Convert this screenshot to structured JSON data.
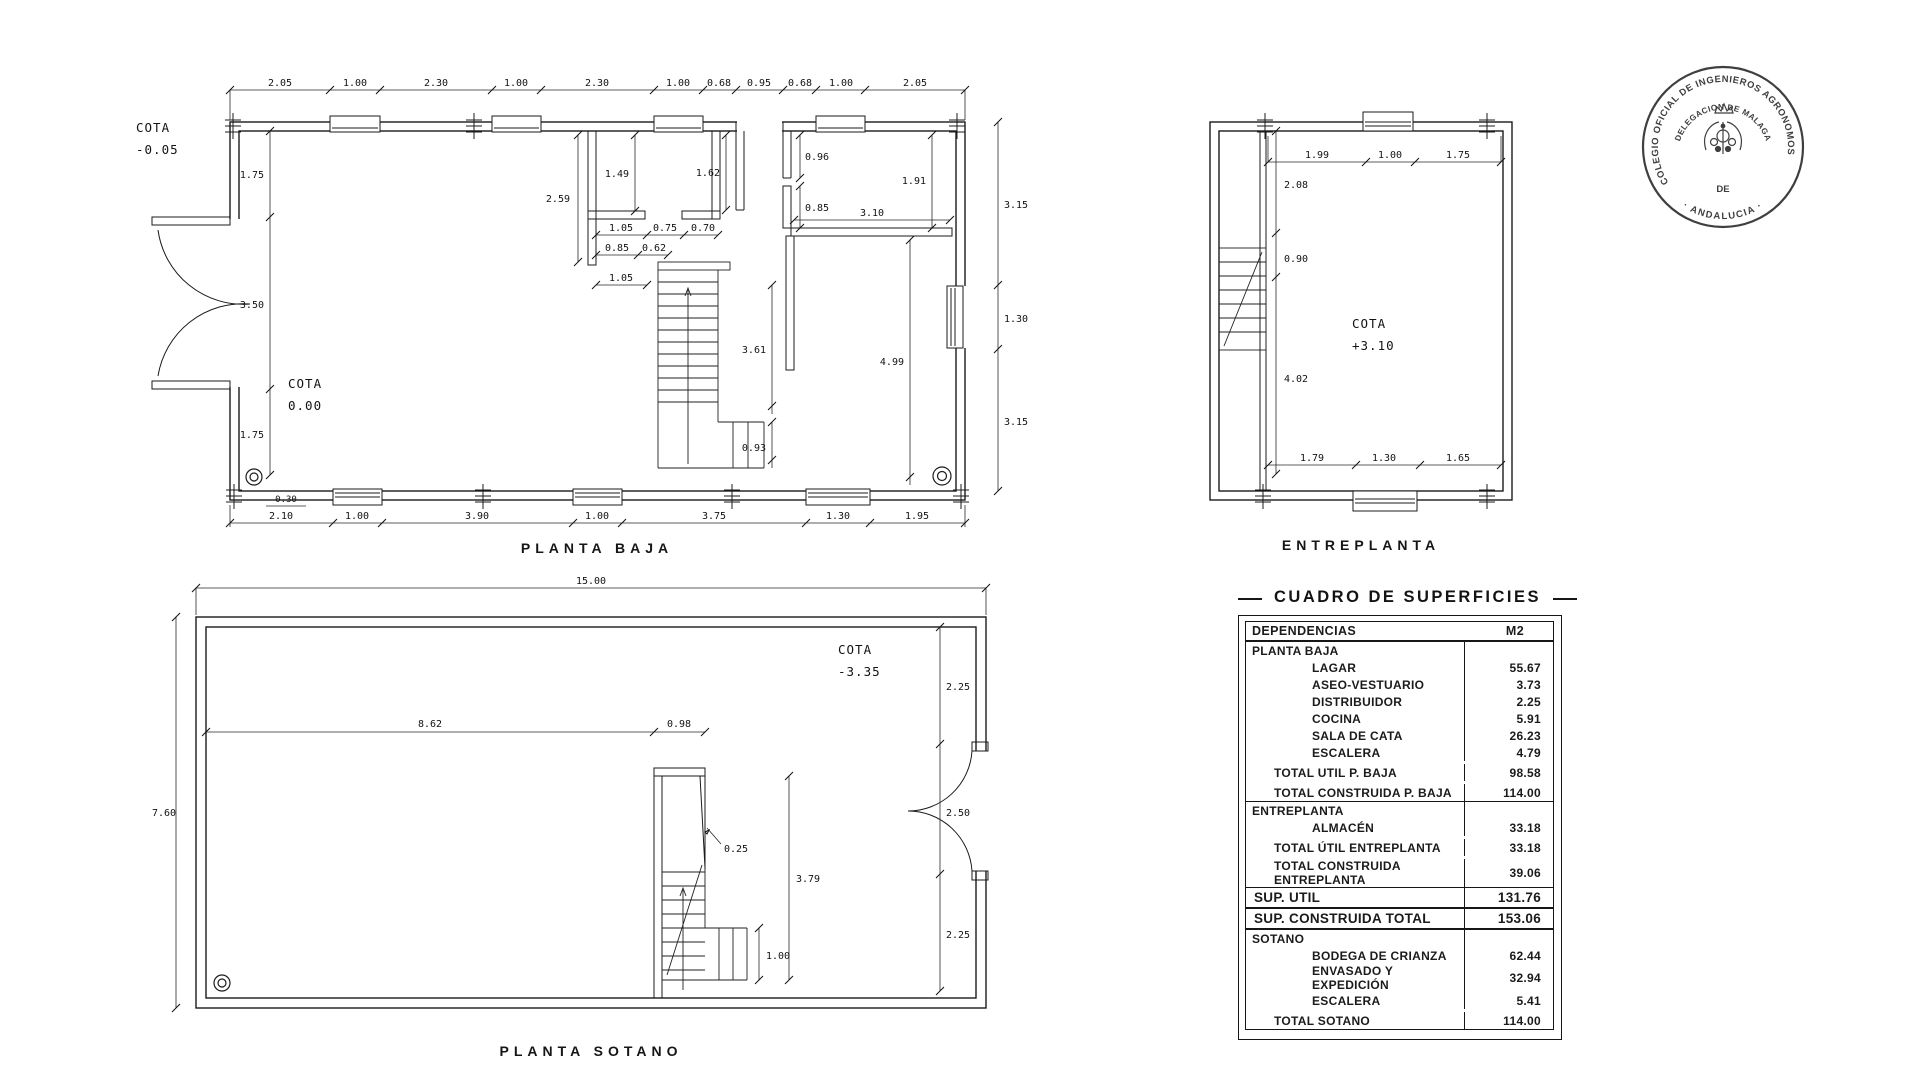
{
  "meta": {
    "ink": "#1b1b1b",
    "stamp_color": "#3f3f3f",
    "background": "#ffffff"
  },
  "plans": {
    "baja": {
      "label": "PLANTA BAJA",
      "cota_out": {
        "l1": "COTA",
        "l2": "-0.05"
      },
      "cota_in": {
        "l1": "COTA",
        "l2": "0.00"
      },
      "dims_top": [
        "2.05",
        "1.00",
        "2.30",
        "1.00",
        "2.30",
        "1.00",
        "0.68",
        "0.95",
        "0.68",
        "1.00",
        "2.05"
      ],
      "dims_bottom": [
        "2.10",
        "1.00",
        "3.90",
        "1.00",
        "3.75",
        "1.30",
        "1.95"
      ],
      "dims_left": [
        "1.75",
        "3.50",
        "1.75"
      ],
      "dims_right": [
        "3.15",
        "1.30",
        "3.15"
      ],
      "din": {
        "d259": "2.59",
        "d149": "1.49",
        "d105a": "1.05",
        "d075": "0.75",
        "d070": "0.70",
        "d085a": "0.85",
        "d062": "0.62",
        "d105b": "1.05",
        "d162": "1.62",
        "d096": "0.96",
        "d085b": "0.85",
        "d310": "3.10",
        "d191": "1.91",
        "d499": "4.99",
        "d361": "3.61",
        "d093": "0.93",
        "d030": "0.30"
      }
    },
    "entreplanta": {
      "label": "ENTREPLANTA",
      "cota": {
        "l1": "COTA",
        "l2": "+3.10"
      },
      "dims_top": [
        "1.99",
        "1.00",
        "1.75"
      ],
      "dims_left": [
        "2.08",
        "0.90",
        "4.02"
      ],
      "dims_bottom": [
        "1.79",
        "1.30",
        "1.65"
      ]
    },
    "sotano": {
      "label": "PLANTA SOTANO",
      "cota": {
        "l1": "COTA",
        "l2": "-3.35"
      },
      "dim_top": "15.00",
      "dim_left": "7.60",
      "dims_right": [
        "2.25",
        "2.50",
        "2.25"
      ],
      "din": {
        "d862": "8.62",
        "d098": "0.98",
        "d025": "0.25",
        "d379": "3.79",
        "d100": "1.00"
      }
    }
  },
  "stamp": {
    "ring_top": "COLEGIO OFICIAL DE INGENIEROS AGRONOMOS",
    "ring_bottom": "· ANDALUCIA ·",
    "inner_arc": "DELEGACION DE MALAGA",
    "center_word": "DE"
  },
  "table": {
    "title": "CUADRO DE SUPERFICIES",
    "col_label": "DEPENDENCIAS",
    "col_value": "M2",
    "rows": [
      {
        "label": "PLANTA BAJA",
        "value": "",
        "type": "section"
      },
      {
        "label": "LAGAR",
        "value": "55.67",
        "type": "item"
      },
      {
        "label": "ASEO-VESTUARIO",
        "value": "3.73",
        "type": "item"
      },
      {
        "label": "DISTRIBUIDOR",
        "value": "2.25",
        "type": "item"
      },
      {
        "label": "COCINA",
        "value": "5.91",
        "type": "item"
      },
      {
        "label": "SALA DE CATA",
        "value": "26.23",
        "type": "item"
      },
      {
        "label": "ESCALERA",
        "value": "4.79",
        "type": "item"
      },
      {
        "label": "TOTAL UTIL P. BAJA",
        "value": "98.58",
        "type": "total"
      },
      {
        "label": "TOTAL CONSTRUIDA P. BAJA",
        "value": "114.00",
        "type": "total"
      },
      {
        "label": "ENTREPLANTA",
        "value": "",
        "type": "section"
      },
      {
        "label": "ALMACÉN",
        "value": "33.18",
        "type": "item"
      },
      {
        "label": "TOTAL ÚTIL ENTREPLANTA",
        "value": "33.18",
        "type": "total"
      },
      {
        "label": "TOTAL CONSTRUIDA ENTREPLANTA",
        "value": "39.06",
        "type": "total"
      },
      {
        "label": "SUP. UTIL",
        "value": "131.76",
        "type": "grand"
      },
      {
        "label": "SUP. CONSTRUIDA TOTAL",
        "value": "153.06",
        "type": "grand"
      },
      {
        "label": "SOTANO",
        "value": "",
        "type": "section"
      },
      {
        "label": "BODEGA DE CRIANZA",
        "value": "62.44",
        "type": "item"
      },
      {
        "label": "ENVASADO Y EXPEDICIÓN",
        "value": "32.94",
        "type": "item"
      },
      {
        "label": "ESCALERA",
        "value": "5.41",
        "type": "item"
      },
      {
        "label": "TOTAL SOTANO",
        "value": "114.00",
        "type": "total"
      }
    ]
  }
}
